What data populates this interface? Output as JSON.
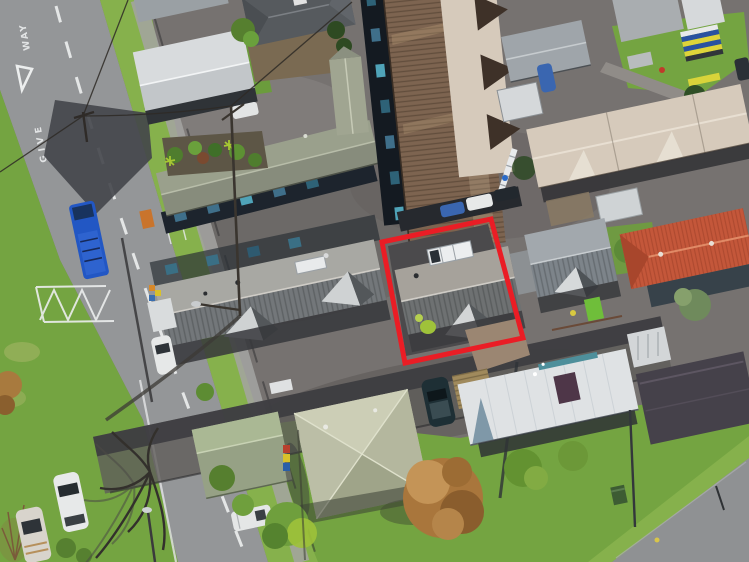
{
  "image": {
    "type": "aerial-drone-photo",
    "subject": "Suburban residential block, top-down aerial view with red property boundary outline around a grey-roof townhouse",
    "t": {
      "give": "GIVE",
      "way": "WAY"
    },
    "hl": {
      "points": "382,242 491,219 523,338 405,363",
      "color": "#ea1d25",
      "width": "5"
    },
    "c": {
      "ground": "#767270",
      "road": "#949698",
      "roadBottom": "#8f9193",
      "grass": "#74a441",
      "grassLight": "#86b14c",
      "grassDark": "#567f2f",
      "marking": "#eceeee",
      "shadow": "#3a3a3e",
      "navyWall": "#1d242d",
      "windowTeal": "#3f6f8a",
      "roofWhiteGable": "#d8dbdd",
      "roofDarkHip": "#565a5e",
      "roofOlive": "#9aa08c",
      "roofBrown": "#7d6450",
      "roofCream": "#d6cabb",
      "roofGreyGable": "#9fa5aa",
      "roofTile": "#a2a8ad",
      "roofTerracotta": "#c4573a",
      "roofTownhouse": "#a8a8a3",
      "roofTownhouseShade": "#73777a",
      "roofHero": "#a6a29b",
      "roofHeroShade": "#6e7172",
      "roofSage": "#b7baa2",
      "roofGreen": "#96a185",
      "roofMetalWhite": "#dfe2e4",
      "roofCharcoal": "#45414a",
      "solar": "#eceeef",
      "truckBlue": "#2257c4",
      "carBlue": "#3a66b0",
      "carWhite": "#e7e9e9",
      "carDark": "#1e2f35",
      "treeGreen": "#567f2f",
      "treeAutumn": "#a9763c",
      "binGreen": "#3d5c33",
      "lime": "#9fc23a"
    }
  }
}
